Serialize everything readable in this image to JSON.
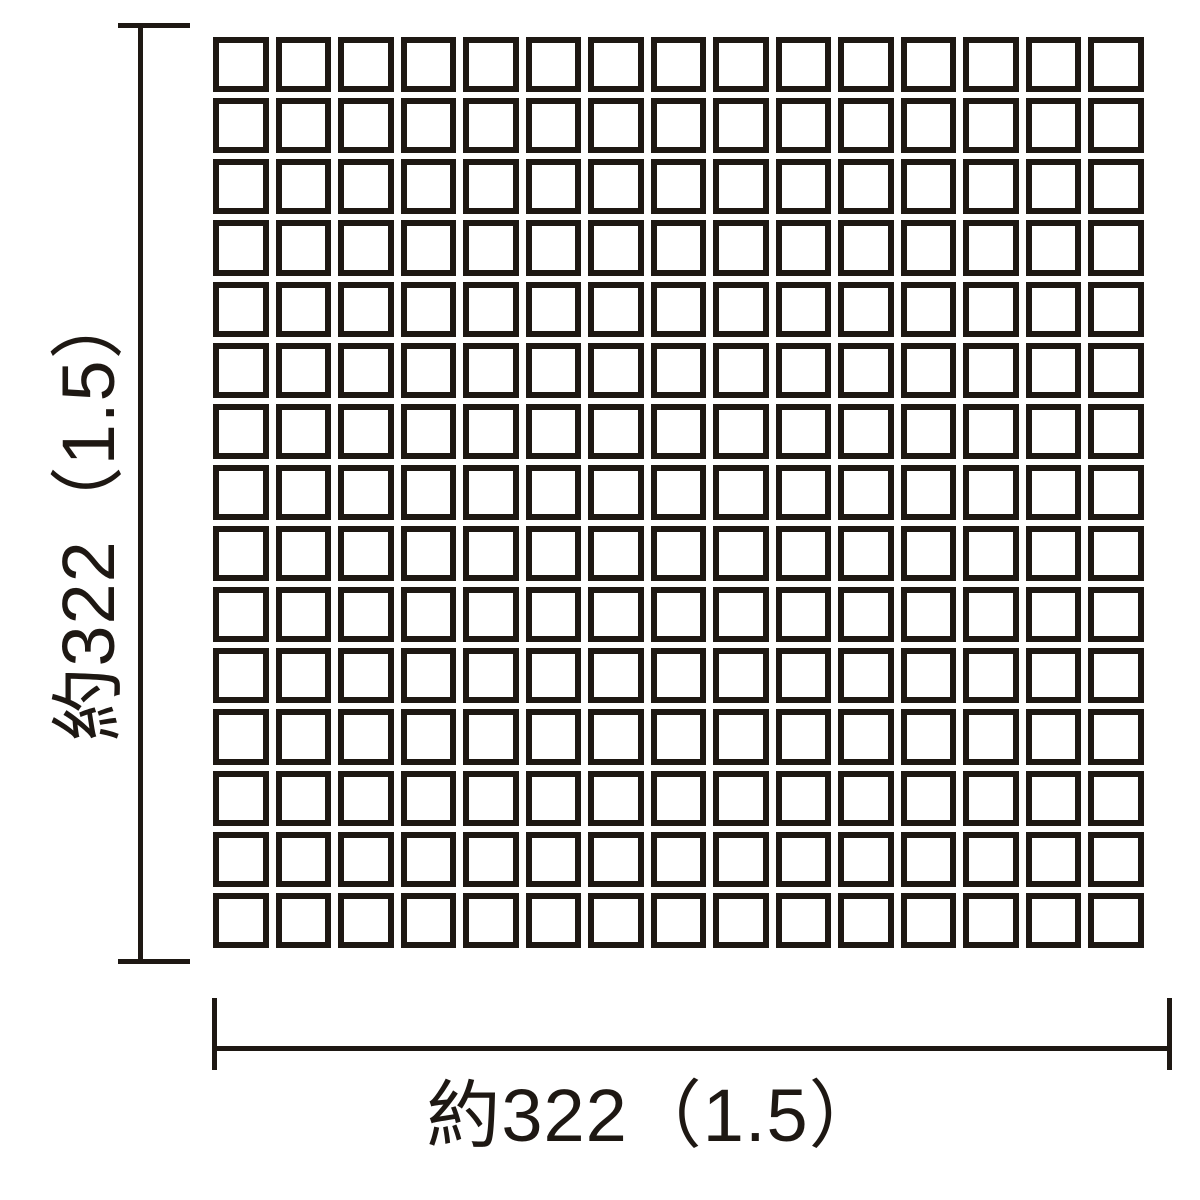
{
  "diagram": {
    "kind": "tile-sheet-dimension-drawing",
    "colors": {
      "ink": "#1e1813",
      "tile_fill": "#ffffff",
      "background": "#ffffff"
    },
    "grid": {
      "rows": 15,
      "cols": 15
    },
    "vertical_dimension": {
      "label": "約322（1.5）"
    },
    "horizontal_dimension": {
      "label": "約322（1.5）"
    }
  }
}
